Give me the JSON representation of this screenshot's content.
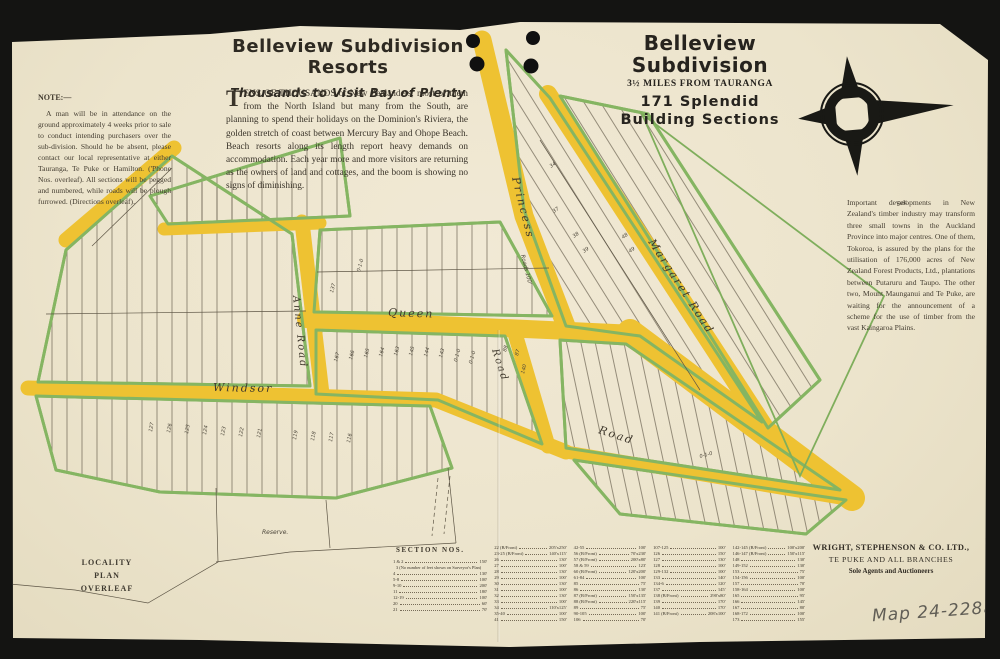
{
  "page": {
    "paper_color": "#ece4cc",
    "road_color": "#eec232",
    "lot_edge_color": "#85b562",
    "ink_color": "#2e2a22",
    "pencil_color": "#605d55"
  },
  "masthead_left": {
    "title": "Belleview Subdivision Resorts",
    "subtitle": "Thousands to Visit Bay of Plenty",
    "dropcap": "T",
    "body": "ENS OF THOUSANDS of New Zealanders, most of them from the North Island but many from the South, are planning to spend their holidays on the Dominion's Riviera, the golden stretch of coast between Mercury Bay and Ohope Beach. Beach resorts along its length report heavy demands on accommodation. Each year more and more visitors are returning as the owners of land and cottages, and the boom is showing no signs of diminishing."
  },
  "masthead_right": {
    "line1": "Belleview",
    "line2": "Subdivision",
    "line3": "3½ MILES FROM TAURANGA",
    "line4": "171 Splendid",
    "line5": "Building Sections"
  },
  "note": {
    "heading": "NOTE:—",
    "body": "A man will be in attendance on the ground approximately 4 weeks prior to sale to conduct intending purchasers over the sub-division. Should he be absent, please contact our local representative at either Tauranga, Te Puke or Hamilton. ('Phone Nos. overleaf).  All sections will be pegged and numbered, while roads will be plough furrowed.  (Directions overleaf)."
  },
  "timber_note": {
    "body": "Important developments in New Zealand's timber industry may transform three small towns in the Auckland Province into major centres.  One of them, Tokoroa, is assured by the plans for the utilisation of 176,000 acres of New Zealand Forest Products, Ltd., plantations between Putaruru and Taupo. The other two, Mount Maunganui and Te Puke, are waiting for the announcement of a scheme for the use of timber from the vast Kaingaroa Plains."
  },
  "locality_note": {
    "lines": [
      "LOCALITY",
      "PLAN",
      "OVERLEAF"
    ]
  },
  "agents": {
    "name": "WRIGHT, STEPHENSON & CO. LTD.,",
    "branches": "TE PUKE AND ALL BRANCHES",
    "role": "Sole Agents and Auctioneers"
  },
  "map_ref": "Map 24-228a",
  "map": {
    "road_labels": [
      {
        "t": "Princess",
        "x": 512,
        "y": 178,
        "r": 76,
        "s": 11
      },
      {
        "t": "Margaret Road",
        "x": 648,
        "y": 242,
        "r": 57,
        "s": 11
      },
      {
        "t": "Queen",
        "x": 388,
        "y": 316,
        "r": 2,
        "s": 11
      },
      {
        "t": "Anne Road",
        "x": 293,
        "y": 296,
        "r": 84,
        "s": 10
      },
      {
        "t": "Windsor",
        "x": 213,
        "y": 391,
        "r": 1,
        "s": 11
      },
      {
        "t": "Road",
        "x": 492,
        "y": 350,
        "r": 72,
        "s": 10
      },
      {
        "t": "Road",
        "x": 598,
        "y": 433,
        "r": 18,
        "s": 11
      }
    ],
    "annotations": [
      {
        "t": "Roads 100'",
        "x": 521,
        "y": 255,
        "r": 76,
        "s": 5.5
      },
      {
        "t": "Reserve.",
        "x": 262,
        "y": 534,
        "r": 0,
        "s": 6
      },
      {
        "t": "Sec.",
        "x": 897,
        "y": 206,
        "r": -12,
        "s": 6
      },
      {
        "t": "137",
        "x": 333,
        "y": 293,
        "r": -75
      },
      {
        "t": "167",
        "x": 337,
        "y": 362,
        "r": -75
      },
      {
        "t": "166",
        "x": 352,
        "y": 360,
        "r": -75
      },
      {
        "t": "165",
        "x": 367,
        "y": 358,
        "r": -75
      },
      {
        "t": "164",
        "x": 382,
        "y": 357,
        "r": -75
      },
      {
        "t": "163",
        "x": 397,
        "y": 356,
        "r": -75
      },
      {
        "t": "145",
        "x": 412,
        "y": 356,
        "r": -75
      },
      {
        "t": "144",
        "x": 427,
        "y": 357,
        "r": -75
      },
      {
        "t": "143",
        "x": 442,
        "y": 358,
        "r": -75
      },
      {
        "t": "0-1-0",
        "x": 457,
        "y": 362,
        "r": -75
      },
      {
        "t": "0-1-0",
        "x": 472,
        "y": 364,
        "r": -75
      },
      {
        "t": "88",
        "x": 506,
        "y": 352,
        "r": -75
      },
      {
        "t": "87",
        "x": 518,
        "y": 356,
        "r": -75
      },
      {
        "t": "140",
        "x": 524,
        "y": 374,
        "r": -75
      },
      {
        "t": "127",
        "x": 152,
        "y": 432,
        "r": -80
      },
      {
        "t": "126",
        "x": 170,
        "y": 433,
        "r": -80
      },
      {
        "t": "125",
        "x": 188,
        "y": 434,
        "r": -80
      },
      {
        "t": "124",
        "x": 206,
        "y": 435,
        "r": -80
      },
      {
        "t": "123",
        "x": 224,
        "y": 436,
        "r": -80
      },
      {
        "t": "122",
        "x": 242,
        "y": 437,
        "r": -80
      },
      {
        "t": "121",
        "x": 260,
        "y": 438,
        "r": -80
      },
      {
        "t": "119",
        "x": 296,
        "y": 440,
        "r": -80
      },
      {
        "t": "118",
        "x": 314,
        "y": 441,
        "r": -80
      },
      {
        "t": "117",
        "x": 332,
        "y": 442,
        "r": -80
      },
      {
        "t": "116",
        "x": 350,
        "y": 443,
        "r": -80
      },
      {
        "t": "34",
        "x": 551,
        "y": 168,
        "r": -35
      },
      {
        "t": "37",
        "x": 554,
        "y": 213,
        "r": -35
      },
      {
        "t": "38",
        "x": 574,
        "y": 238,
        "r": -35
      },
      {
        "t": "39",
        "x": 584,
        "y": 253,
        "r": -35
      },
      {
        "t": "48",
        "x": 623,
        "y": 239,
        "r": -35
      },
      {
        "t": "49",
        "x": 630,
        "y": 253,
        "r": -35
      },
      {
        "t": "0-1-0",
        "x": 360,
        "y": 272,
        "r": -75
      },
      {
        "t": "0-1-0",
        "x": 700,
        "y": 458,
        "r": -15
      }
    ]
  },
  "section_table": {
    "heading": "SECTION NOS.",
    "columns": [
      [
        {
          "n": "1 & 2",
          "d": "150'"
        },
        {
          "note": "3 (No number of feet shown on Surveyor's Plan)"
        },
        {
          "n": "4",
          "d": "130'"
        },
        {
          "n": "5-8",
          "d": "100'"
        },
        {
          "n": "9-10",
          "d": "200'"
        },
        {
          "n": "11",
          "d": "180'"
        },
        {
          "n": "12-19",
          "d": "100'"
        },
        {
          "n": "20",
          "d": "60'"
        },
        {
          "n": "21",
          "d": "70'"
        }
      ],
      [
        {
          "n": "22 (B/Front)",
          "d": "205'x250'"
        },
        {
          "n": "23-25 (B/Front)",
          "d": "140'x115'"
        },
        {
          "n": "26",
          "d": "130'"
        },
        {
          "n": "27",
          "d": "100'"
        },
        {
          "n": "28",
          "d": "130'"
        },
        {
          "n": "29",
          "d": "100'"
        },
        {
          "n": "30",
          "d": "130'"
        },
        {
          "n": "31",
          "d": "100'"
        },
        {
          "n": "32",
          "d": "130'"
        },
        {
          "n": "33",
          "d": "100'"
        },
        {
          "n": "34",
          "d": "110'x125'"
        },
        {
          "n": "35-40",
          "d": "100'"
        },
        {
          "n": "41",
          "d": "150'"
        }
      ],
      [
        {
          "n": "42-55",
          "d": "100'"
        },
        {
          "n": "56 (B/Front)",
          "d": "70'x230'"
        },
        {
          "n": "57 (B/Front)",
          "d": "200'x80'"
        },
        {
          "n": "58 & 59",
          "d": "123'"
        },
        {
          "n": "60 (B/Front)",
          "d": "120'x200'"
        },
        {
          "n": "61-84",
          "d": "100'"
        },
        {
          "n": "85",
          "d": "75'"
        },
        {
          "n": "86",
          "d": "130'"
        },
        {
          "n": "87 (B/Front)",
          "d": "150'x135'"
        },
        {
          "n": "88 (B/Front)",
          "d": "220'x115'"
        },
        {
          "n": "89",
          "d": "75'"
        },
        {
          "n": "90-105",
          "d": "100'"
        },
        {
          "n": "106",
          "d": "70'"
        }
      ],
      [
        {
          "n": "107-125",
          "d": "100'"
        },
        {
          "n": "126",
          "d": "150'"
        },
        {
          "n": "127",
          "d": "130'"
        },
        {
          "n": "128",
          "d": "100'"
        },
        {
          "n": "129-132",
          "d": "100'"
        },
        {
          "n": "133",
          "d": "140'"
        },
        {
          "n": "134-6",
          "d": "120'"
        },
        {
          "n": "137",
          "d": "145'"
        },
        {
          "n": "138 (B/Front)",
          "d": "290'x80'"
        },
        {
          "n": "139",
          "d": "170'"
        },
        {
          "n": "140",
          "d": "170'"
        },
        {
          "n": "141 (B/Front)",
          "d": "208'x100'"
        }
      ],
      [
        {
          "n": "142-145 (B/Front)",
          "d": "100'x200'"
        },
        {
          "n": "146-147 (B/Front)",
          "d": "150'x115'"
        },
        {
          "n": "148",
          "d": "130'"
        },
        {
          "n": "149-152",
          "d": "130'"
        },
        {
          "n": "153",
          "d": "75'"
        },
        {
          "n": "154-156",
          "d": "100'"
        },
        {
          "n": "157",
          "d": "70'"
        },
        {
          "n": "158-164",
          "d": "100'"
        },
        {
          "n": "165",
          "d": "95'"
        },
        {
          "n": "166",
          "d": "145'"
        },
        {
          "n": "167",
          "d": "80'"
        },
        {
          "n": "168-172",
          "d": "100'"
        },
        {
          "n": "173",
          "d": "155'"
        }
      ]
    ]
  }
}
